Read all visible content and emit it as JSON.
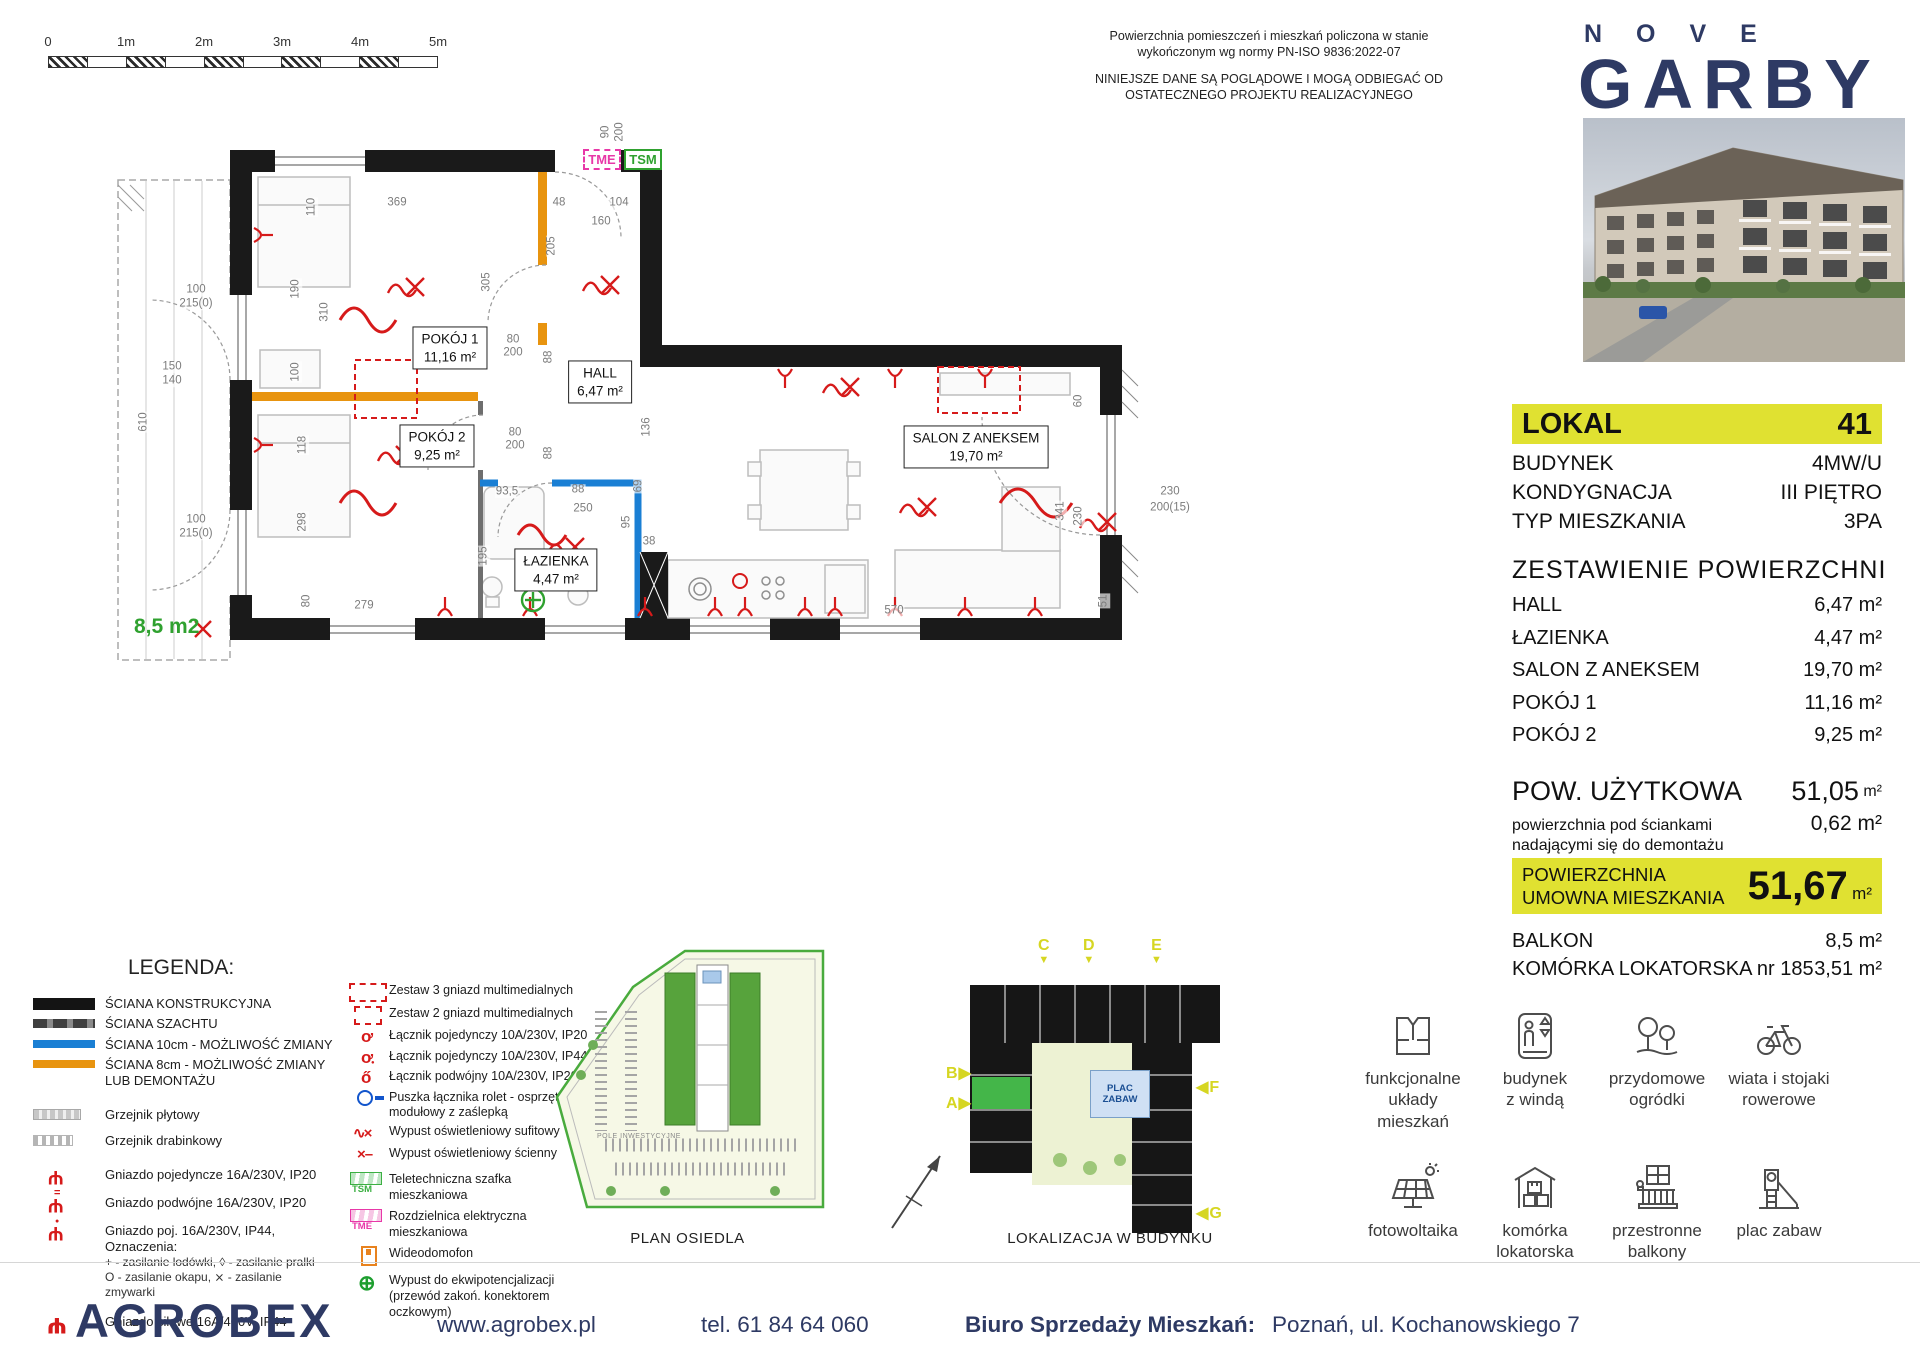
{
  "scalebar": {
    "labels": [
      "0",
      "1m",
      "2m",
      "3m",
      "4m",
      "5m"
    ]
  },
  "disclaimer": {
    "p1": "Powierzchnia pomieszczeń i mieszkań policzona w stanie\nwykończonym wg normy PN-ISO 9836:2022-07",
    "p2": "NINIEJSZE DANE SĄ POGLĄDOWE I MOGĄ ODBIEGAĆ OD\nOSTATECZNEGO PROJEKTU REALIZACYJNEGO"
  },
  "brand": {
    "top": "NOVE",
    "main": "GARBY"
  },
  "unit": {
    "label": "LOKAL",
    "number": "41",
    "info": [
      {
        "label": "BUDYNEK",
        "value": "4MW/U"
      },
      {
        "label": "KONDYGNACJA",
        "value": "III PIĘTRO"
      },
      {
        "label": "TYP MIESZKANIA",
        "value": "3PA"
      }
    ],
    "areas_title": "ZESTAWIENIE  POWIERZCHNI",
    "areas": [
      {
        "label": "HALL",
        "value": "6,47 m²"
      },
      {
        "label": "ŁAZIENKA",
        "value": "4,47 m²"
      },
      {
        "label": "SALON Z ANEKSEM",
        "value": "19,70 m²"
      },
      {
        "label": "POKÓJ 1",
        "value": "11,16 m²"
      },
      {
        "label": "POKÓJ 2",
        "value": "9,25 m²"
      }
    ],
    "usable_label": "POW. UŻYTKOWA",
    "usable_value": "51,05",
    "usable_unit": "m²",
    "note_label": "powierzchnia pod ściankami\nnadającymi się do demontażu",
    "note_value": "0,62 m²",
    "contract_label": "POWIERZCHNIA\nUMOWNA MIESZKANIA",
    "contract_value": "51,67",
    "contract_unit": "m²",
    "extras": [
      {
        "label": "BALKON",
        "value": "8,5 m²"
      },
      {
        "label": "KOMÓRKA LOKATORSKA nr 185",
        "value": "3,51 m²"
      }
    ]
  },
  "plan": {
    "tme": "TME",
    "tsm": "TSM",
    "balcony_label": "8,5 m2",
    "rooms": [
      {
        "name": "POKÓJ 1",
        "area": "11,16 m²",
        "x": 350,
        "y": 233
      },
      {
        "name": "POKÓJ 2",
        "area": "9,25 m²",
        "x": 337,
        "y": 331
      },
      {
        "name": "HALL",
        "area": "6,47 m²",
        "x": 500,
        "y": 267
      },
      {
        "name": "ŁAZIENKA",
        "area": "4,47 m²",
        "x": 456,
        "y": 455
      },
      {
        "name": "SALON Z ANEKSEM",
        "area": "19,70 m²",
        "x": 876,
        "y": 332
      }
    ],
    "dims": [
      {
        "t": "90",
        "x": 506,
        "y": 17,
        "r": -90
      },
      {
        "t": "200",
        "x": 520,
        "y": 17,
        "r": -90
      },
      {
        "t": "369",
        "x": 297,
        "y": 88
      },
      {
        "t": "48",
        "x": 459,
        "y": 88
      },
      {
        "t": "104",
        "x": 519,
        "y": 88
      },
      {
        "t": "160",
        "x": 501,
        "y": 107
      },
      {
        "t": "205",
        "x": 452,
        "y": 131,
        "r": -90
      },
      {
        "t": "305",
        "x": 387,
        "y": 167,
        "r": -90
      },
      {
        "t": "110",
        "x": 212,
        "y": 92,
        "r": -90
      },
      {
        "t": "190",
        "x": 196,
        "y": 174,
        "r": -90
      },
      {
        "t": "310",
        "x": 225,
        "y": 197,
        "r": -90
      },
      {
        "t": "100",
        "x": 196,
        "y": 257,
        "r": -90
      },
      {
        "t": "118",
        "x": 203,
        "y": 330,
        "r": -90
      },
      {
        "t": "298",
        "x": 203,
        "y": 407,
        "r": -90
      },
      {
        "t": "80",
        "x": 413,
        "y": 225
      },
      {
        "t": "200",
        "x": 413,
        "y": 238
      },
      {
        "t": "88",
        "x": 449,
        "y": 242,
        "r": -90
      },
      {
        "t": "80",
        "x": 415,
        "y": 318
      },
      {
        "t": "200",
        "x": 415,
        "y": 331
      },
      {
        "t": "88",
        "x": 449,
        "y": 338,
        "r": -90
      },
      {
        "t": "93,5",
        "x": 407,
        "y": 377
      },
      {
        "t": "88",
        "x": 478,
        "y": 375
      },
      {
        "t": "250",
        "x": 483,
        "y": 394
      },
      {
        "t": "69",
        "x": 539,
        "y": 371,
        "r": -90
      },
      {
        "t": "95",
        "x": 527,
        "y": 407,
        "r": -90
      },
      {
        "t": "38",
        "x": 549,
        "y": 427
      },
      {
        "t": "136",
        "x": 547,
        "y": 312,
        "r": -90
      },
      {
        "t": "195",
        "x": 384,
        "y": 441,
        "r": -90
      },
      {
        "t": "279",
        "x": 264,
        "y": 491
      },
      {
        "t": "80",
        "x": 207,
        "y": 486,
        "r": -90
      },
      {
        "t": "570",
        "x": 794,
        "y": 496
      },
      {
        "t": "341",
        "x": 961,
        "y": 396,
        "r": -90
      },
      {
        "t": "230",
        "x": 979,
        "y": 401,
        "r": -90
      },
      {
        "t": "60",
        "x": 979,
        "y": 286,
        "r": -90
      },
      {
        "t": "51",
        "x": 1004,
        "y": 486,
        "r": -90
      },
      {
        "t": "230",
        "x": 1070,
        "y": 377
      },
      {
        "t": "200(15)",
        "x": 1070,
        "y": 393
      },
      {
        "t": "100",
        "x": 96,
        "y": 175
      },
      {
        "t": "215(0)",
        "x": 96,
        "y": 189
      },
      {
        "t": "100",
        "x": 96,
        "y": 405
      },
      {
        "t": "215(0)",
        "x": 96,
        "y": 419
      },
      {
        "t": "150",
        "x": 72,
        "y": 252
      },
      {
        "t": "140",
        "x": 72,
        "y": 266
      },
      {
        "t": "610",
        "x": 44,
        "y": 307,
        "r": -90
      }
    ]
  },
  "legend": {
    "title": "LEGENDA:",
    "col1": [
      {
        "icon": "ic-wall-black",
        "label": "ŚCIANA KONSTRUKCYJNA"
      },
      {
        "icon": "ic-wall-shaft",
        "label": "ŚCIANA SZACHTU"
      },
      {
        "icon": "ic-wall-blue",
        "label": "ŚCIANA 10cm - MOŻLIWOŚĆ ZMIANY"
      },
      {
        "icon": "ic-wall-orange",
        "label": "ŚCIANA 8cm - MOŻLIWOŚĆ ZMIANY\nLUB DEMONTAŻU"
      },
      {
        "icon": "ic-radiator-panel",
        "label": "Grzejnik płytowy",
        "mt": 14
      },
      {
        "icon": "ic-radiator-ladder",
        "label": "Grzejnik drabinkowy",
        "mt": 5
      },
      {
        "icon": "ic-socket-single",
        "label": "Gniazdo pojedyncze 16A/230V, IP20",
        "mt": 14
      },
      {
        "icon": "ic-socket-double",
        "label": "Gniazdo podwójne 16A/230V, IP20",
        "mt": 5
      },
      {
        "icon": "ic-socket-ip44",
        "label": "Gniazdo poj. 16A/230V, IP44, Oznaczenia:",
        "sub": "+  - zasilanie lodówki,   ◊  - zasilanie pralki\nO  - zasilanie okapu,   ⨯  - zasilanie zmywarki",
        "mt": 5
      },
      {
        "icon": "ic-socket-power",
        "label": "Gniazdo siłowe 16A/400V, IP44",
        "mt": 10
      }
    ],
    "col2": [
      {
        "icon": "ic-mm3",
        "label": "Zestaw 3 gniazd multimedialnych"
      },
      {
        "icon": "ic-mm2",
        "label": "Zestaw 2 gniazd multimedialnych"
      },
      {
        "icon": "ic-switch",
        "label": "Łącznik pojedynczy 10A/230V, IP20"
      },
      {
        "icon": "ic-switch-44",
        "label": "Łącznik pojedynczy 10A/230V, IP44"
      },
      {
        "icon": "ic-switch-dbl",
        "label": "Łącznik podwójny 10A/230V, IP20"
      },
      {
        "icon": "ic-roller",
        "label": "Puszka łącznika rolet - osprzęt modułowy z zaślepką"
      },
      {
        "icon": "ic-light-ceiling",
        "label": "Wypust oświetleniowy sufitowy"
      },
      {
        "icon": "ic-light-wall",
        "label": "Wypust oświetleniowy ścienny"
      },
      {
        "icon": "ic-tsm",
        "tag": "TSM",
        "label": "Teletechniczna szafka mieszkaniowa",
        "mt": 6
      },
      {
        "icon": "ic-tme",
        "tag": "TME",
        "label": "Rozdzielnica elektryczna mieszkaniowa",
        "mt": 2
      },
      {
        "icon": "ic-intercom",
        "label": "Wideodomofon",
        "mt": 2
      },
      {
        "icon": "ic-equipotential",
        "label": "Wypust do ekwipotencjalizacji\n(przewód zakoń. konektorem oczkowym)",
        "mt": 4
      }
    ]
  },
  "minimaps": {
    "site_caption": "PLAN OSIEDLA",
    "site_inner": "POLE INWESTYCYJNE",
    "building_caption": "LOKALIZACJA  W BUDYNKU",
    "playground": "PLAC\nZABAW",
    "markers": [
      {
        "cls": "v",
        "t1": "C",
        "t2": "▼",
        "x": 88,
        "y": 8
      },
      {
        "cls": "v",
        "t1": "D",
        "t2": "▼",
        "x": 133,
        "y": 8
      },
      {
        "cls": "v",
        "t1": "E",
        "t2": "▼",
        "x": 201,
        "y": 8
      },
      {
        "cls": "h",
        "t1": "B",
        "t2": "▶",
        "x": -4,
        "y": 136
      },
      {
        "cls": "h",
        "t1": "A",
        "t2": "▶",
        "x": -4,
        "y": 166
      },
      {
        "cls": "h",
        "t1": "◀",
        "t2": "F",
        "x": 246,
        "y": 150
      },
      {
        "cls": "h",
        "t1": "◀",
        "t2": "G",
        "x": 246,
        "y": 276
      }
    ]
  },
  "amenities": [
    {
      "icon": "apartment-layout-icon",
      "label": "funkcjonalne\nukłady mieszkań"
    },
    {
      "icon": "elevator-icon",
      "label": "budynek\nz windą"
    },
    {
      "icon": "garden-icon",
      "label": "przydomowe\nogródki"
    },
    {
      "icon": "bike-shed-icon",
      "label": "wiata i stojaki\nrowerowe"
    },
    {
      "icon": "solar-icon",
      "label": "fotowoltaika"
    },
    {
      "icon": "storage-icon",
      "label": "komórka\nlokatorska"
    },
    {
      "icon": "balcony-icon",
      "label": "przestronne\nbalkony"
    },
    {
      "icon": "playground-icon",
      "label": "plac zabaw"
    }
  ],
  "footer": {
    "logo": "AGROBEX",
    "website": "www.agrobex.pl",
    "phone": "tel. 61 84 64 060",
    "office_label": "Biuro Sprzedaży Mieszkań:",
    "office_address": "Poznań, ul. Kochanowskiego 7"
  }
}
